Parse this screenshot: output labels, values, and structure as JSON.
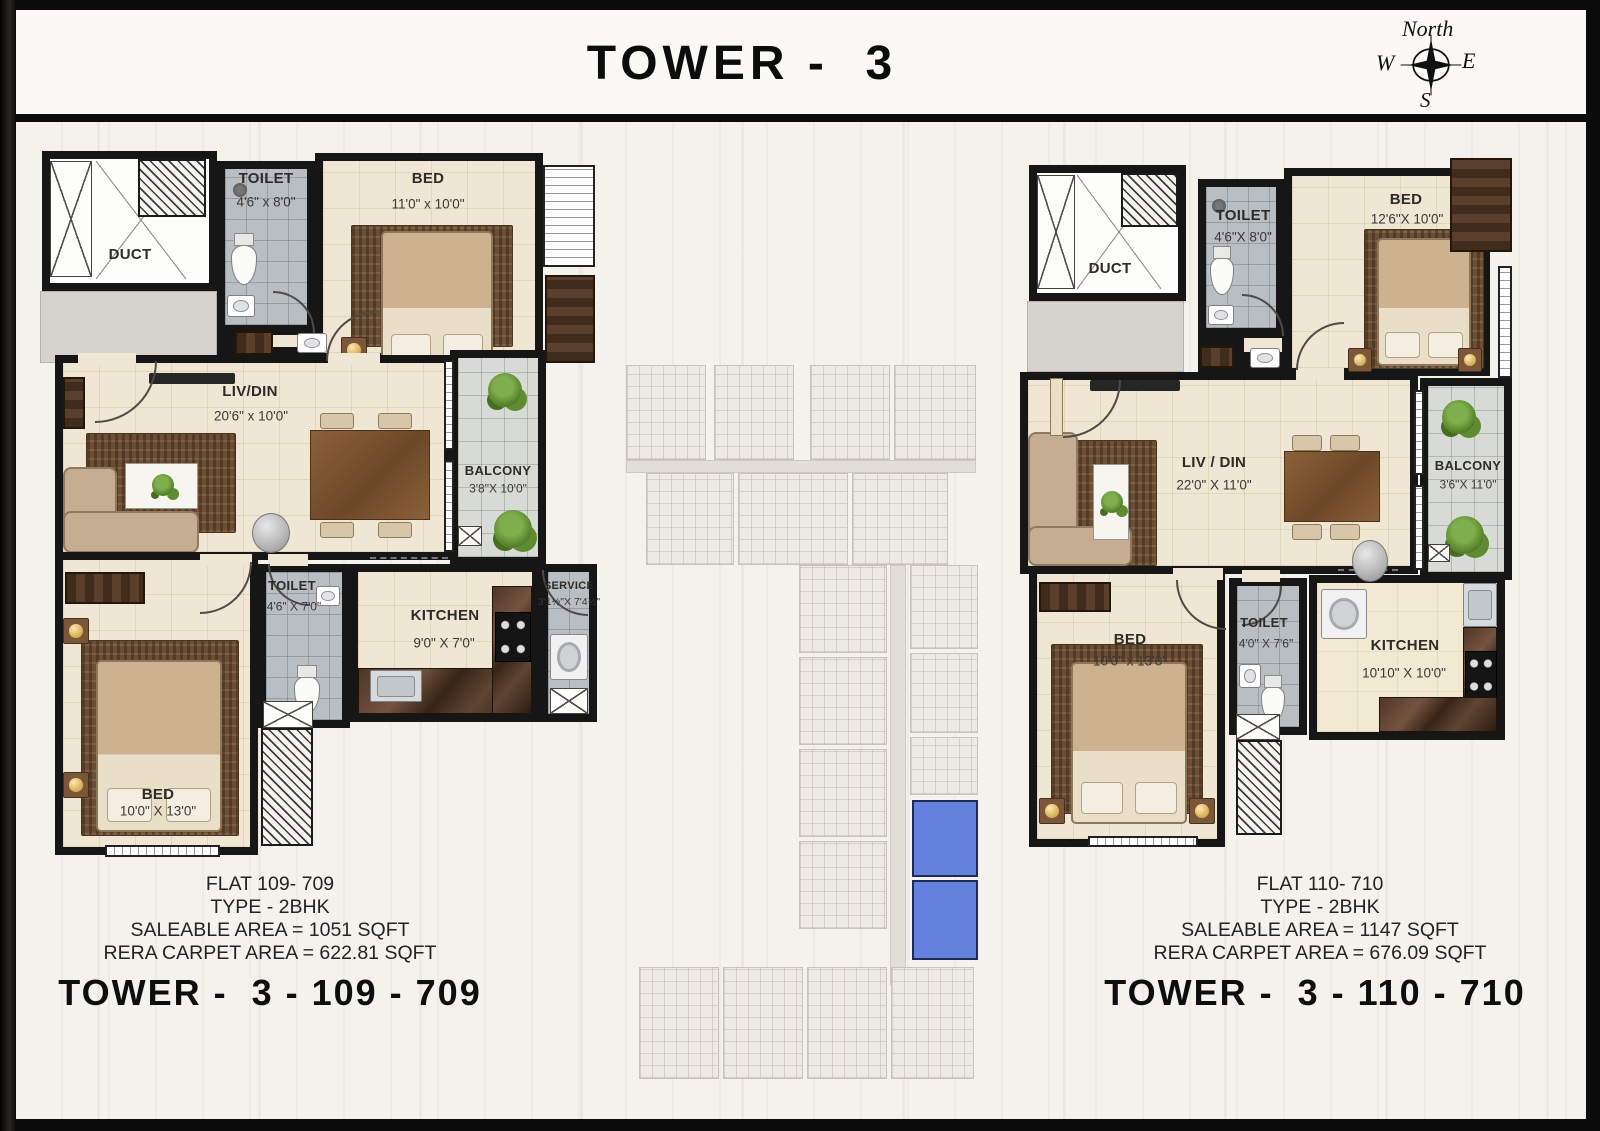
{
  "title": "TOWER -  3",
  "compass": {
    "north": "North",
    "west": "W",
    "east": "E",
    "south": "S"
  },
  "flat_a": {
    "tower_label": "TOWER -  3 - 109 - 709",
    "info_lines": [
      "FLAT 109- 709",
      "TYPE - 2BHK",
      "SALEABLE AREA = 1051 SQFT",
      "RERA CARPET AREA = 622.81 SQFT"
    ],
    "rooms": {
      "duct": {
        "name": "DUCT"
      },
      "toilet_top": {
        "name": "TOILET",
        "dim": "4'6\" x 8'0\""
      },
      "bed_top": {
        "name": "BED",
        "dim": "11'0\" x 10'0\""
      },
      "livdin": {
        "name": "LIV/DIN",
        "dim": "20'6\" x 10'0\""
      },
      "balcony": {
        "name": "BALCONY",
        "dim": "3'8\"X 10'0\""
      },
      "bed_bottom": {
        "name": "BED",
        "dim": "10'0\" X 13'0\""
      },
      "toilet_bottom": {
        "name": "TOILET",
        "dim": "4'6\" X 7'0\""
      },
      "kitchen": {
        "name": "KITCHEN",
        "dim": "9'0\" X 7'0\""
      },
      "service": {
        "name": "SERVICE",
        "dim": "3'1½\"X 7'4½\""
      }
    }
  },
  "flat_b": {
    "tower_label": "TOWER -  3 - 110 - 710",
    "info_lines": [
      "FLAT 110- 710",
      "TYPE - 2BHK",
      "SALEABLE AREA = 1147 SQFT",
      "RERA CARPET AREA = 676.09 SQFT"
    ],
    "rooms": {
      "duct": {
        "name": "DUCT"
      },
      "toilet_top": {
        "name": "TOILET",
        "dim": "4'6\"X 8'0\""
      },
      "bed_top": {
        "name": "BED",
        "dim": "12'6\"X 10'0\""
      },
      "livdin": {
        "name": "LIV / DIN",
        "dim": "22'0\" X 11'0\""
      },
      "balcony": {
        "name": "BALCONY",
        "dim": "3'6\"X 11'0\""
      },
      "bed_bottom": {
        "name": "BED",
        "dim": "10'0\" x 13'0\""
      },
      "toilet_bottom": {
        "name": "TOILET",
        "dim": "4'0\" X 7'6\""
      },
      "kitchen": {
        "name": "KITCHEN",
        "dim": "10'10\" X 10'0\""
      }
    }
  },
  "keyplan": {
    "highlight_color": "#6282de"
  }
}
